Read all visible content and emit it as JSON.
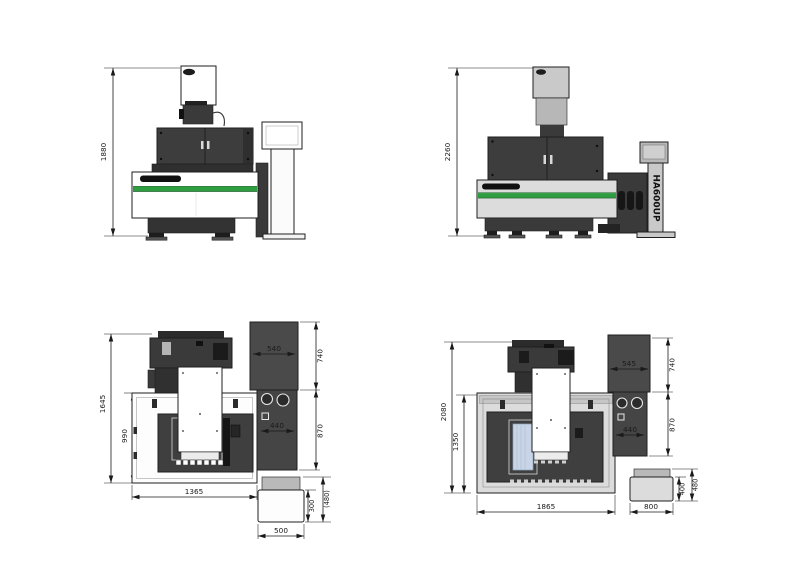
{
  "title": "HA600UP machine dimension drawing",
  "model_label": "HA600UP",
  "colors": {
    "line": "#1a1a1a",
    "machine_dark": "#3d3d3d",
    "machine_darker": "#1e1e1e",
    "light_gray": "#c9c9c9",
    "base_gray": "#dcdcdc",
    "green_stripe": "#2f9e41",
    "table_blue": "#c9d5e6",
    "white": "#ffffff"
  },
  "views": {
    "front_a": {
      "height": "1880"
    },
    "front_b": {
      "height": "2260"
    },
    "plan_a": {
      "depth_total": "1645",
      "tank_depth": "990",
      "width": "1365",
      "cabinet_width": "540",
      "cabinet_depth": "740",
      "panel_width": "440",
      "panel_depth": "870",
      "box_body_depth": "300",
      "box_total_depth": "(480)",
      "box_width": "500"
    },
    "plan_b": {
      "depth_total": "2080",
      "tank_depth": "1350",
      "width": "1865",
      "cabinet_width": "545",
      "cabinet_depth": "740",
      "panel_width": "440",
      "panel_depth": "870",
      "box_body_depth": "400",
      "box_total_depth": "480",
      "box_width": "800"
    }
  }
}
